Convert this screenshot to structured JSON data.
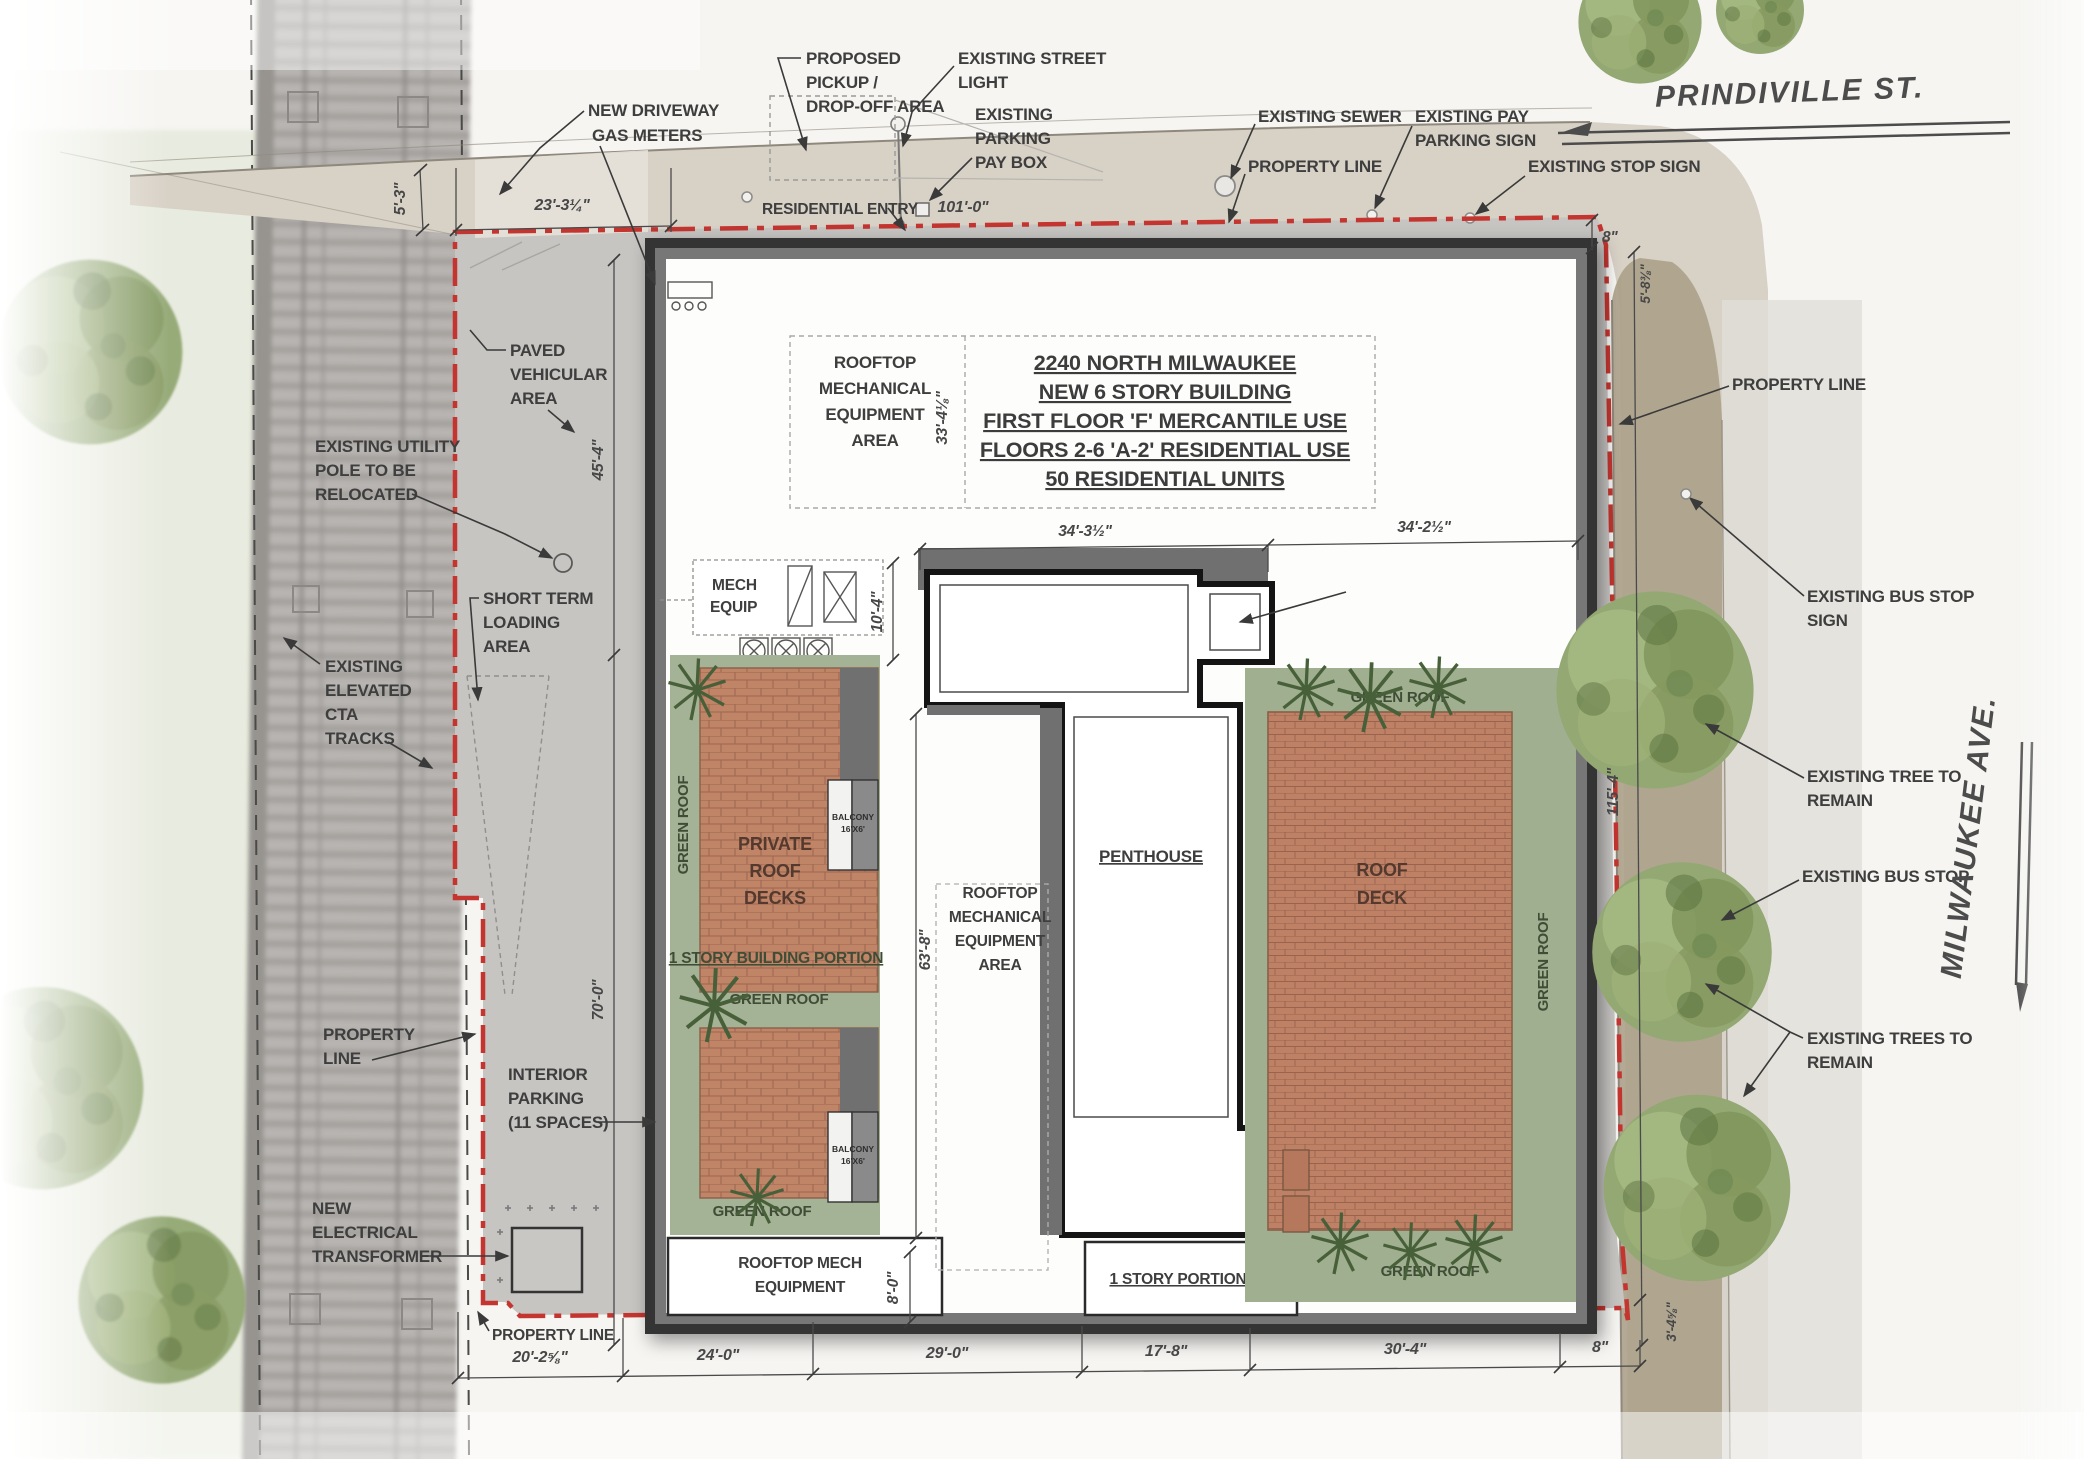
{
  "streets": {
    "top": "PRINDIVILLE  ST.",
    "right": "MILWAUKEE  AVE."
  },
  "building": {
    "title": [
      "2240 NORTH MILWAUKEE",
      "NEW 6 STORY BUILDING",
      "FIRST FLOOR 'F' MERCANTILE USE",
      "FLOORS 2-6 'A-2' RESIDENTIAL USE",
      "50 RESIDENTIAL UNITS"
    ],
    "rooftop_mech_area_top": [
      "ROOFTOP",
      "MECHANICAL",
      "EQUIPMENT",
      "AREA"
    ],
    "rooftop_mech_area_center": [
      "ROOFTOP",
      "MECHANICAL",
      "EQUIPMENT",
      "AREA"
    ],
    "rooftop_mech_equipment": [
      "ROOFTOP MECH",
      "EQUIPMENT"
    ],
    "mech_equip": [
      "MECH",
      "EQUIP"
    ],
    "elevator_overrun": [
      "ELEVATOR",
      "OVERRUN"
    ],
    "penthouse": "PENTHOUSE",
    "green_roof": "GREEN ROOF",
    "private_roof_decks": [
      "PRIVATE",
      "ROOF",
      "DECKS"
    ],
    "balcony": [
      "BALCONY",
      "16'X6'"
    ],
    "one_story_building_portion": "1 STORY BUILDING PORTION",
    "one_story_portion": "1 STORY PORTION",
    "roof_deck": [
      "ROOF",
      "DECK"
    ]
  },
  "annotations": {
    "proposed_pickup": [
      "PROPOSED",
      "PICKUP /",
      "DROP-OFF AREA"
    ],
    "existing_street_light": [
      "EXISTING STREET",
      "LIGHT"
    ],
    "existing_parking_pay_box": [
      "EXISTING",
      "PARKING",
      "PAY BOX"
    ],
    "existing_sewer": "EXISTING SEWER",
    "property_line_top": "PROPERTY LINE",
    "existing_pay_parking_sign": [
      "EXISTING PAY",
      "PARKING SIGN"
    ],
    "existing_stop_sign": "EXISTING STOP SIGN",
    "new_driveway": "NEW DRIVEWAY",
    "gas_meters": "GAS METERS",
    "residential_entry": "RESIDENTIAL ENTRY",
    "paved_vehicular_area": [
      "PAVED",
      "VEHICULAR",
      "AREA"
    ],
    "existing_utility_pole": [
      "EXISTING UTILITY",
      "POLE TO BE",
      "RELOCATED"
    ],
    "short_term_loading": [
      "SHORT TERM",
      "LOADING",
      "AREA"
    ],
    "existing_cta": [
      "EXISTING",
      "ELEVATED",
      "CTA",
      "TRACKS"
    ],
    "property_line_left": [
      "PROPERTY",
      "LINE"
    ],
    "interior_parking": [
      "INTERIOR",
      "PARKING",
      "(11 SPACES)"
    ],
    "new_electrical_transformer": [
      "NEW",
      "ELECTRICAL",
      "TRANSFORMER"
    ],
    "property_line_bottom": "PROPERTY LINE",
    "property_line_right": "PROPERTY LINE",
    "existing_bus_stop_sign": [
      "EXISTING BUS STOP",
      "SIGN"
    ],
    "existing_tree_to_remain": [
      "EXISTING TREE TO",
      "REMAIN"
    ],
    "existing_bus_stop": "EXISTING BUS STOP",
    "existing_trees_to_remain": [
      "EXISTING TREES TO",
      "REMAIN"
    ]
  },
  "dims": {
    "curb_offset": "5'-3\"",
    "top_left_width": "23'-3¼\"",
    "top_width": "101'-0\"",
    "top_right_offset": "8\"",
    "right_top_offset": "5'-8⅜\"",
    "west_upper": "45'-4\"",
    "west_lower": "70'-0\"",
    "mech_area_height": "33'-4⅛\"",
    "penthouse_west": "34'-3½\"",
    "penthouse_east": "34'-2½\"",
    "mech_equip_height": "10'-4\"",
    "center_height": "63'-8\"",
    "center_bottom": "8'-0\"",
    "east_side": "115'-4\"",
    "bottom_right_offset": "3'-4⅝\"",
    "bottom": [
      "20'-2⅝\"",
      "24'-0\"",
      "29'-0\"",
      "17'-8\"",
      "30'-4\"",
      "8\""
    ]
  },
  "colors": {
    "property_line": "#c43530",
    "green_roof": "#a4b295",
    "deck_pavers": "#c08467",
    "shadow": "#707070",
    "paving": "#c7c5c2",
    "sidewalk": "#d8d1c6",
    "parkway": "#aca189"
  }
}
